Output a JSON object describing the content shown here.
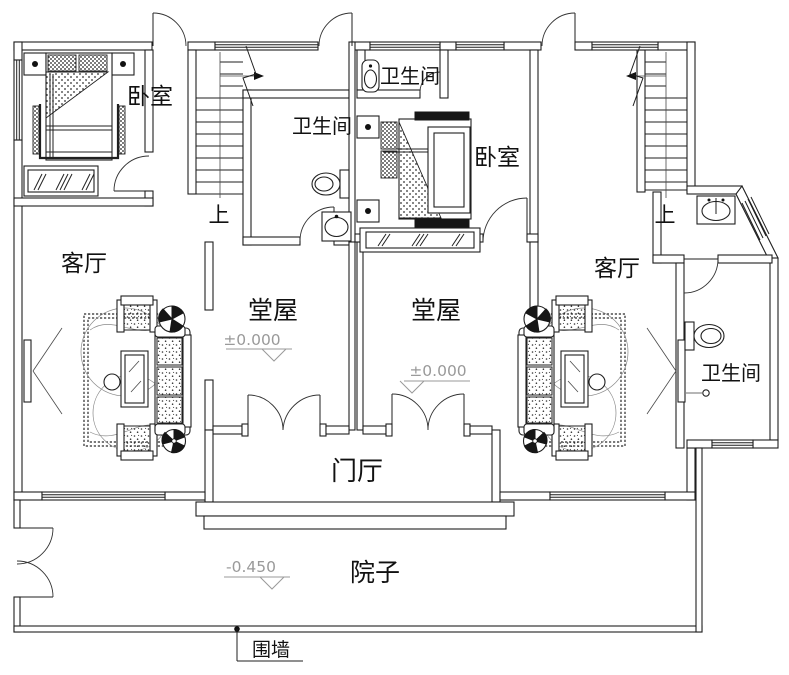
{
  "colors": {
    "background": "#ffffff",
    "line": "#1f1f1f",
    "dim_text": "#9a9a9a",
    "text": "#111111"
  },
  "labels": {
    "bedroom_left": "卧室",
    "bedroom_center": "卧室",
    "bathroom_center_top": "卫生间",
    "bathroom_center_left": "卫生间",
    "bathroom_right": "卫生间",
    "living_left": "客厅",
    "living_right": "客厅",
    "hall_left": "堂屋",
    "hall_right": "堂屋",
    "entry_hall": "门厅",
    "courtyard": "院子",
    "fence_wall": "围墙",
    "stairs_up_left": "上",
    "stairs_up_right": "上"
  },
  "elevations": {
    "hall_left": "±0.000",
    "hall_right": "±0.000",
    "courtyard": "-0.450"
  }
}
